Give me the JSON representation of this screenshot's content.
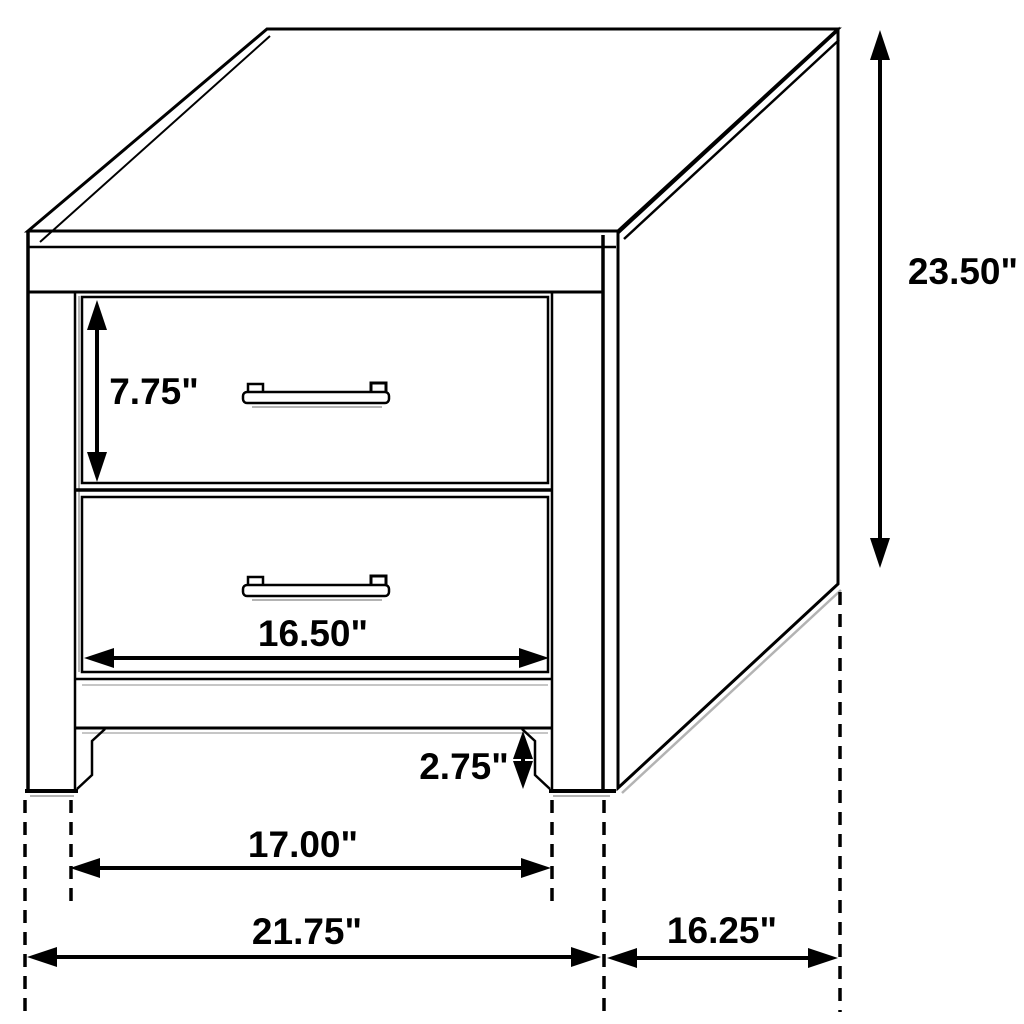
{
  "diagram": {
    "subject": "two-drawer nightstand dimension drawing",
    "unit": "inches",
    "colors": {
      "background": "#ffffff",
      "line": "#000000",
      "shadow": "#b3b3b3"
    },
    "dimensions": {
      "overall_height": "23.50\"",
      "top_drawer_height": "7.75\"",
      "drawer_front_width": "16.50\"",
      "base_clearance": "2.75\"",
      "inner_leg_span": "17.00\"",
      "overall_width": "21.75\"",
      "side_depth": "16.25\""
    }
  }
}
